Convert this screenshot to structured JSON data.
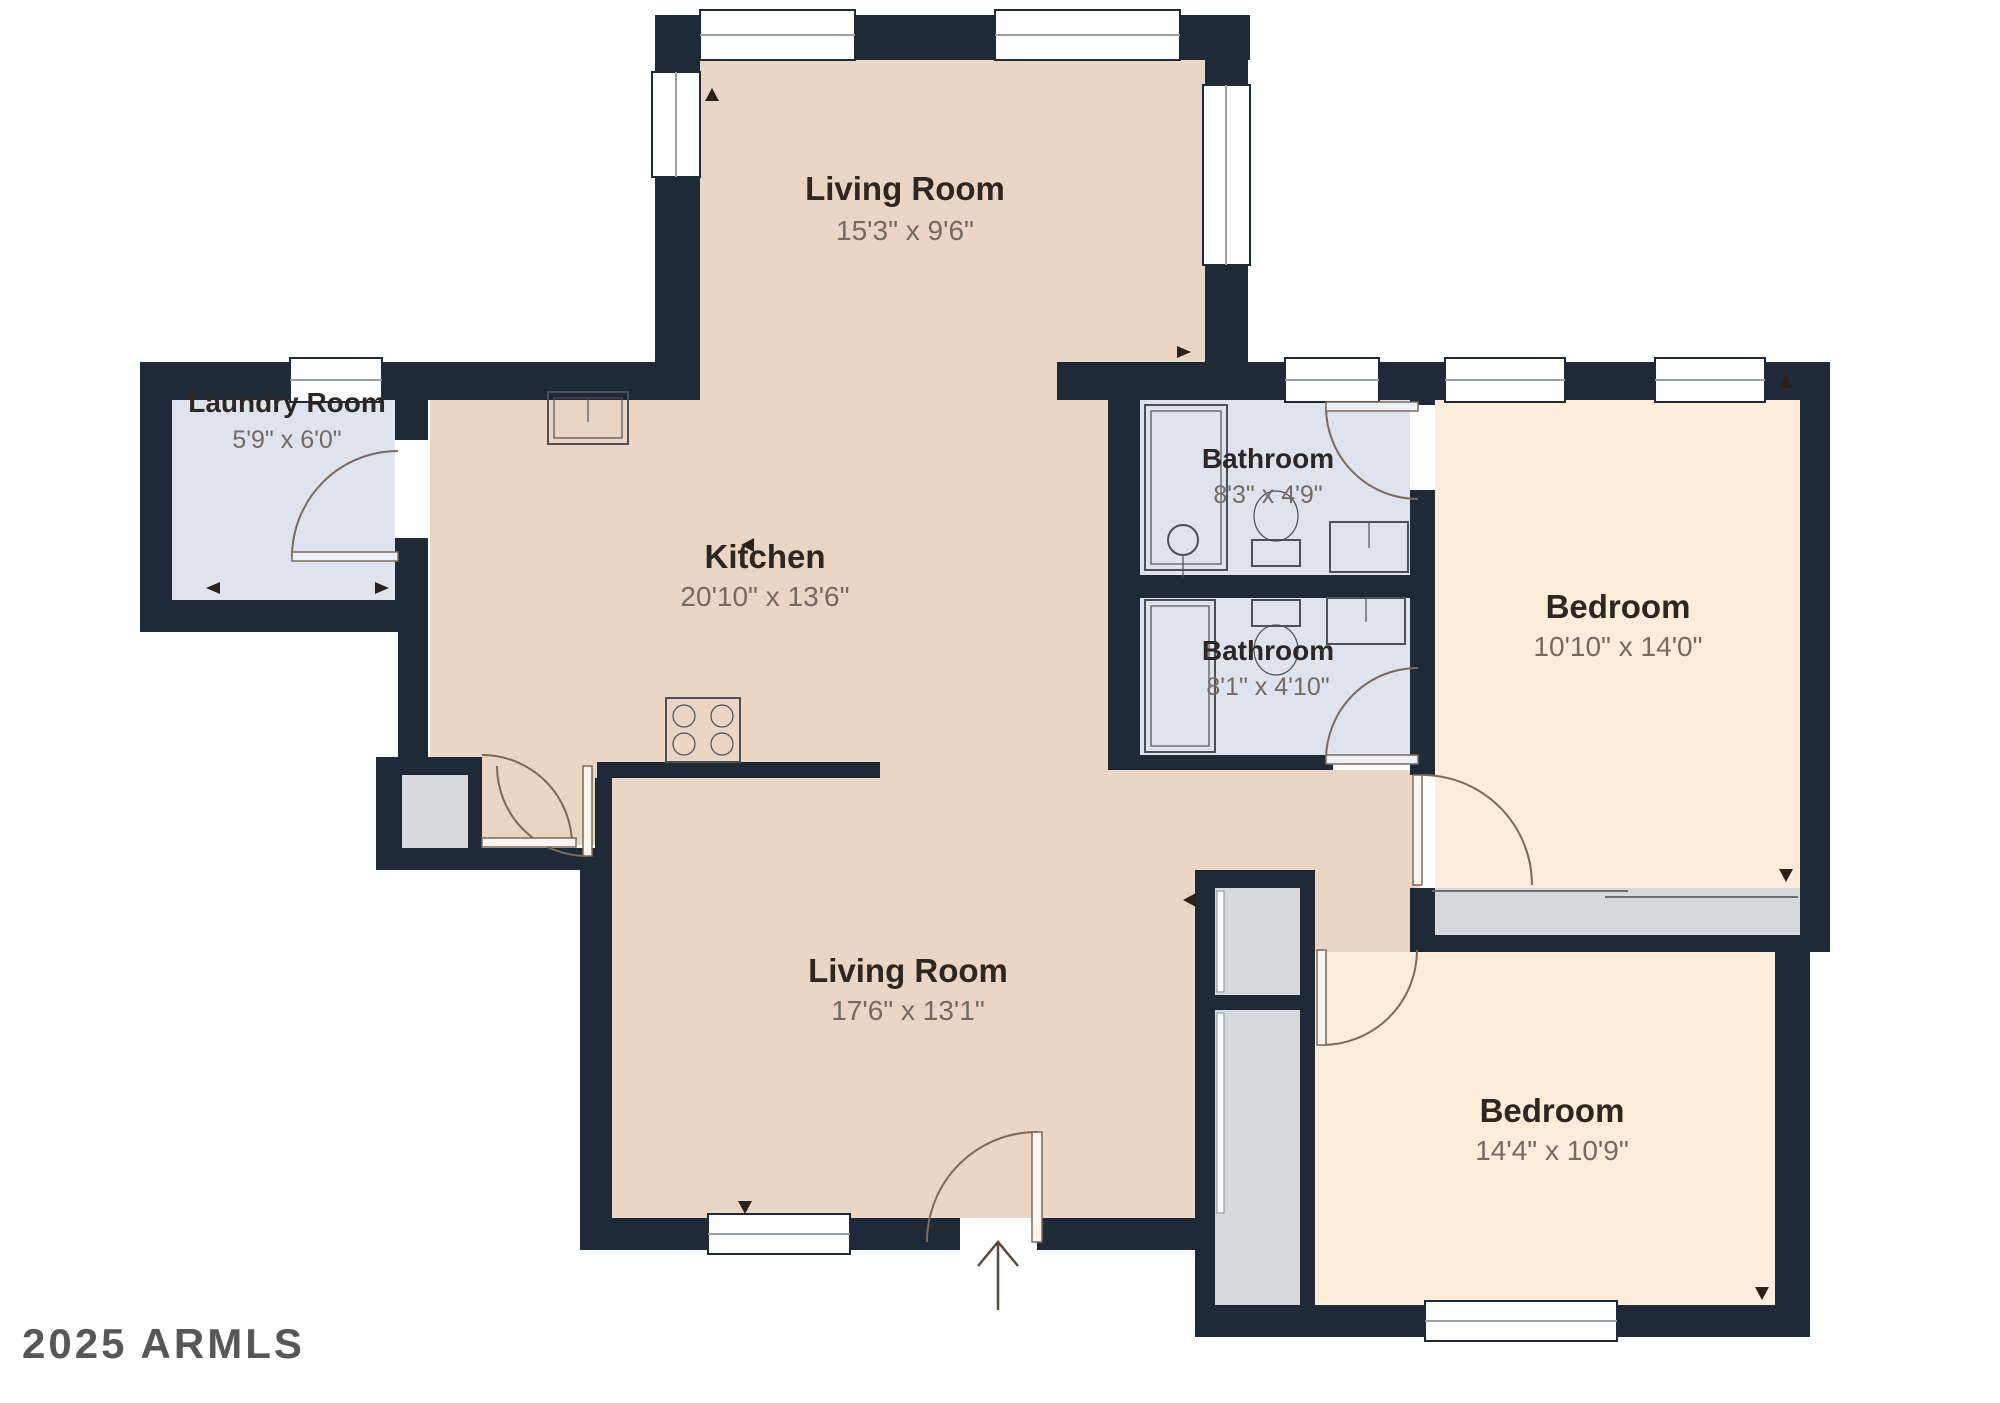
{
  "watermark": "2025 ARMLS",
  "colors": {
    "wall": "#1e2a38",
    "floor_main": "#ebd5c5",
    "floor_bedroom": "#fcecda",
    "floor_bath": "#dfe3ee",
    "floor_closet": "#d6d8db",
    "door_line": "#7a6a58",
    "label": "#2e2621",
    "dims": "#756a60"
  },
  "rooms": [
    {
      "id": "living-room-top",
      "name": "Living Room",
      "dims": "15'3\" x 9'6\""
    },
    {
      "id": "laundry-room",
      "name": "Laundry Room",
      "dims": "5'9\" x 6'0\""
    },
    {
      "id": "kitchen",
      "name": "Kitchen",
      "dims": "20'10\" x 13'6\""
    },
    {
      "id": "bathroom-1",
      "name": "Bathroom",
      "dims": "8'3\" x 4'9\""
    },
    {
      "id": "bathroom-2",
      "name": "Bathroom",
      "dims": "8'1\" x 4'10\""
    },
    {
      "id": "bedroom-1",
      "name": "Bedroom",
      "dims": "10'10\" x 14'0\""
    },
    {
      "id": "living-room-main",
      "name": "Living Room",
      "dims": "17'6\" x 13'1\""
    },
    {
      "id": "bedroom-2",
      "name": "Bedroom",
      "dims": "14'4\" x 10'9\""
    }
  ]
}
